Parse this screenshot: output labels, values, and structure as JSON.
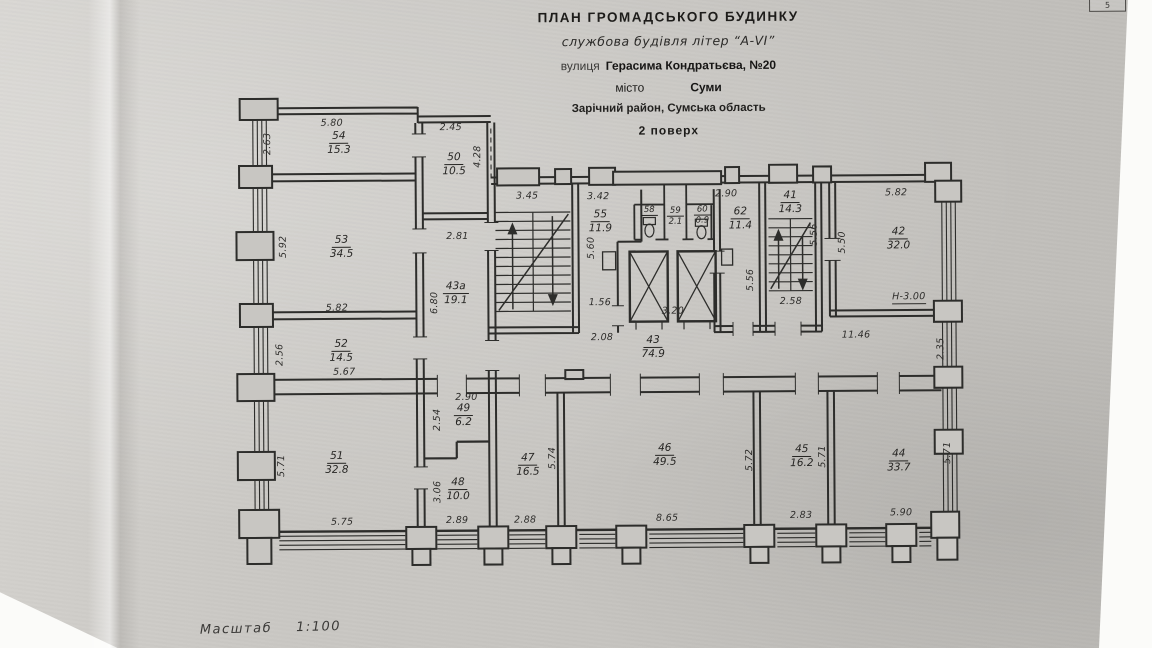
{
  "page": {
    "corner_number": "5",
    "scale_label": "Масштаб",
    "scale_value": "1:100"
  },
  "title": {
    "line1": "ПЛАН  ГРОМАДСЬКОГО  БУДИНКУ",
    "line2": "службова будівля літер “А-VI”",
    "line3_label": "вулиця",
    "line3_value": "Герасима Кондратьєва, №20",
    "line4_label": "місто",
    "line4_value": "Суми",
    "line5": "Зарічний район, Сумська область",
    "line6": "2 поверх"
  },
  "plan": {
    "rooms": {
      "r54": {
        "num": "54",
        "area": "15.3"
      },
      "r50": {
        "num": "50",
        "area": "10.5"
      },
      "r53": {
        "num": "53",
        "area": "34.5"
      },
      "r43a": {
        "num": "43а",
        "area": "19.1"
      },
      "r52": {
        "num": "52",
        "area": "14.5"
      },
      "r49": {
        "num": "49",
        "area": "6.2"
      },
      "r48": {
        "num": "48",
        "area": "10.0"
      },
      "r51": {
        "num": "51",
        "area": "32.8"
      },
      "r55": {
        "num": "55",
        "area": "11.9"
      },
      "r58": {
        "num": "58"
      },
      "r59": {
        "num": "59",
        "area": "2.1"
      },
      "r60": {
        "num": "60",
        "area": "0.9"
      },
      "r62": {
        "num": "62",
        "area": "11.4"
      },
      "r41": {
        "num": "41",
        "area": "14.3"
      },
      "r42": {
        "num": "42",
        "area": "32.0"
      },
      "r43": {
        "num": "43",
        "area": "74.9"
      },
      "r47": {
        "num": "47",
        "area": "16.5"
      },
      "r46": {
        "num": "46",
        "area": "49.5"
      },
      "r45": {
        "num": "45",
        "area": "16.2"
      },
      "r44": {
        "num": "44",
        "area": "33.7"
      }
    },
    "dims": {
      "d54_top": "5.80",
      "d54_left": "2.63",
      "d50_top": "2.45",
      "d50_right": "4.28",
      "d53_left": "5.92",
      "d53_bottom": "5.82",
      "d43a_top": "2.81",
      "d43a_left": "6.80",
      "d52_left": "2.56",
      "d52_bottom": "5.67",
      "d49_top": "2.90",
      "d49_left": "2.54",
      "d48_left": "3.06",
      "d48_bottom": "2.89",
      "d51_left": "5.71",
      "d51_bottom": "5.75",
      "d_stair_left_top": "3.45",
      "d55_top": "3.42",
      "d55_left": "5.60",
      "d55_bottom": "1.56",
      "d_corridor_left": "2.08",
      "d_lobby_bottom": "3.20",
      "d62_top": "2.90",
      "d62_right": "5.56",
      "d41_right": "5.56",
      "d41_bottom": "2.58",
      "d42_top": "5.82",
      "d42_left": "5.50",
      "d42_height": "Н-3.00",
      "d_corridor_right": "11.46",
      "d_right_wall": "2.35",
      "d47_right": "5.74",
      "d47_bottom": "2.88",
      "d46_bottom": "8.65",
      "d46_right": "5.72",
      "d45_right": "5.71",
      "d45_bottom": "2.83",
      "d44_bottom": "5.90",
      "d44_right": "5.71"
    }
  }
}
